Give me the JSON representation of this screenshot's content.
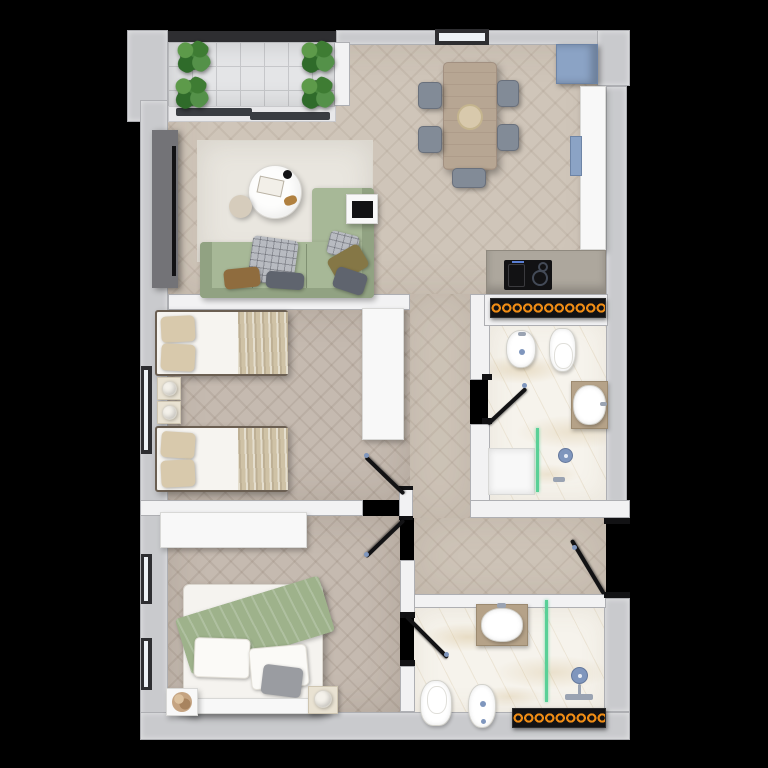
{
  "scene": {
    "type": "apartment-floor-plan-3d-render",
    "view": "top-down",
    "background": "black",
    "visible_text": ""
  },
  "colors": {
    "bg": "#000000",
    "wall-ext": "#c9cacd",
    "wall-int": "#f2f2f3",
    "wall-edge": "#aeafb3",
    "wall-dark": "#2e2e31",
    "floor-wood": "#cfc5b9",
    "floor-wood-dark": "#c5bab0",
    "balcony-tile": "#e4e5e7",
    "tile-line": "#c6c7ca",
    "marble": "#f6f3ec",
    "sofa": "#a7b897",
    "sofa-dark": "#91a282",
    "rug": "#e9e6df",
    "table-wood": "#b7a693",
    "chair-gray": "#828b97",
    "chair-dark": "#69707c",
    "fridge-blue": "#8ba3c5",
    "white-furn": "#f8f8f8",
    "furn-edge": "#d8d8d6",
    "cream": "#e9e2d2",
    "beige": "#d8c9ac",
    "blanket": "#cfc2a6",
    "green-throw": "#9eb28b",
    "gray-cushion": "#9a9ca1",
    "pillow-brown": "#8f6c3e",
    "pillow-olive": "#857746",
    "pillow-gray": "#5f646e",
    "plaid": "#b8bbc1",
    "tv-unit": "#737377",
    "black": "#121214",
    "radiator-ring": "#ef8c15",
    "glass-green": "#5ad097",
    "fixture-blue": "#7f96bd",
    "tan-counter": "#b5a288",
    "lamp-white": "#f4f1ea",
    "dried-plant": "#c5a482",
    "glass-white": "#eef2f6",
    "pouf": "#d6ccbc"
  },
  "rooms": [
    {
      "name": "balcony",
      "items": [
        "tile-floor",
        "plant",
        "plant",
        "plant",
        "plant",
        "sliding-door"
      ]
    },
    {
      "name": "living-dining-kitchen",
      "items": [
        "tv-unit",
        "rug",
        "coffee-table",
        "pouf",
        "l-shaped-sofa",
        "tray-table",
        "dining-table",
        "chairs",
        "fridge",
        "tall-counter",
        "sink",
        "cooktop-counter"
      ]
    },
    {
      "name": "twin-bedroom",
      "items": [
        "single-bed",
        "single-bed",
        "nightstand",
        "nightstand",
        "wardrobe",
        "window",
        "door"
      ]
    },
    {
      "name": "bathroom-top",
      "items": [
        "radiator",
        "bidet",
        "toilet",
        "vanity-sink",
        "shower",
        "glass-screen",
        "door"
      ]
    },
    {
      "name": "hallway",
      "items": []
    },
    {
      "name": "entry-vestibule",
      "items": [
        "entrance-door"
      ]
    },
    {
      "name": "master-bedroom",
      "items": [
        "wardrobe",
        "double-bed",
        "nightstand",
        "nightstand",
        "windows",
        "door"
      ]
    },
    {
      "name": "bathroom-bottom",
      "items": [
        "vanity-sink",
        "toilet",
        "bidet",
        "shower",
        "glass-screen",
        "radiator",
        "door"
      ]
    }
  ],
  "counts": {
    "balcony_plants": 4,
    "dining_chairs": 5,
    "twin_beds": 2,
    "radiator_rings_top": 11,
    "radiator_rings_bottom": 9,
    "doors_with_swing": 5,
    "left_wall_windows": 3
  }
}
